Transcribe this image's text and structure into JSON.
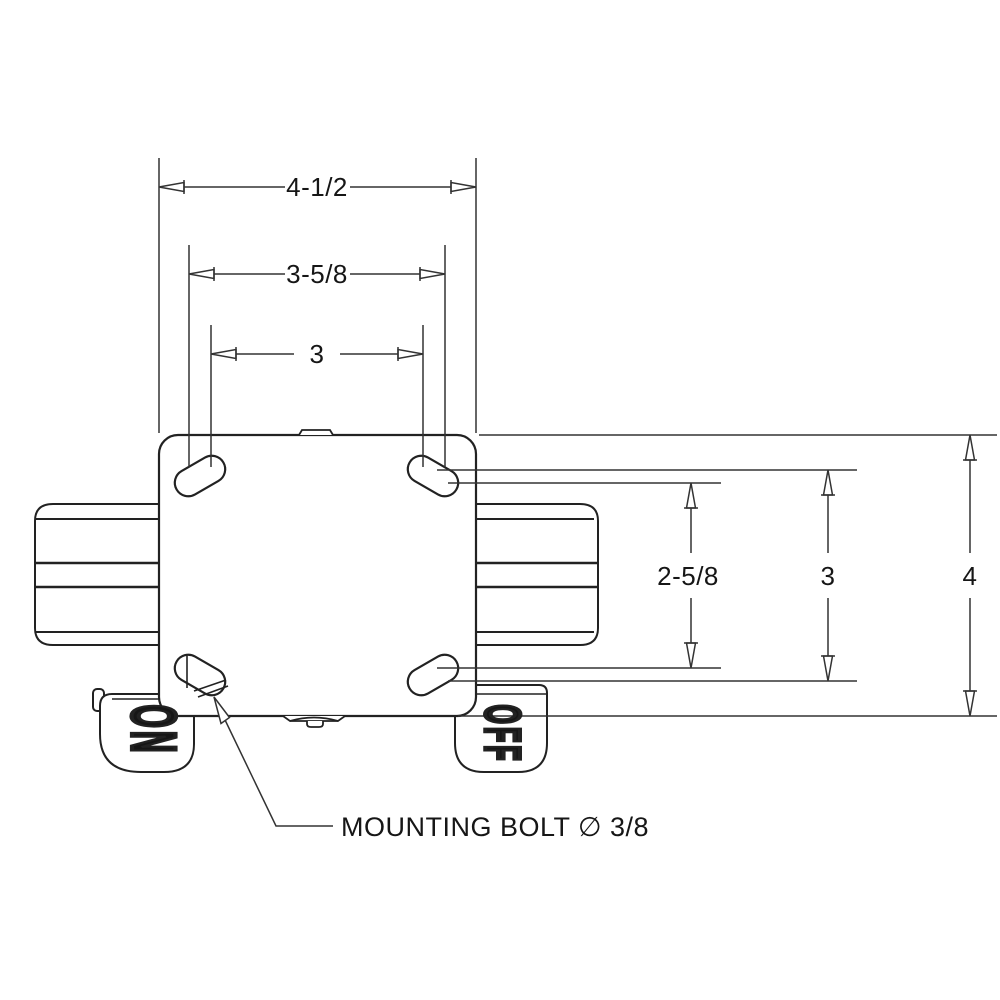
{
  "drawing": {
    "type": "caster-mounting-plate-top-view",
    "background": "#ffffff",
    "line_color": "#222222",
    "top_dimensions": [
      {
        "name": "overall-width",
        "label": "4-1/2"
      },
      {
        "name": "bolt-slot-outer-span",
        "label": "3-5/8"
      },
      {
        "name": "bolt-slot-inner-span",
        "label": "3"
      }
    ],
    "right_dimensions": [
      {
        "name": "bolt-slot-inner-span",
        "label": "2-5/8"
      },
      {
        "name": "bolt-slot-outer-span",
        "label": "3"
      },
      {
        "name": "overall-height",
        "label": "4"
      }
    ],
    "note": {
      "label": "MOUNTING BOLT ∅ 3/8"
    },
    "pedals": [
      {
        "name": "brake-pedal-left",
        "label": "ON"
      },
      {
        "name": "brake-pedal-right",
        "label": "OFF"
      }
    ]
  }
}
